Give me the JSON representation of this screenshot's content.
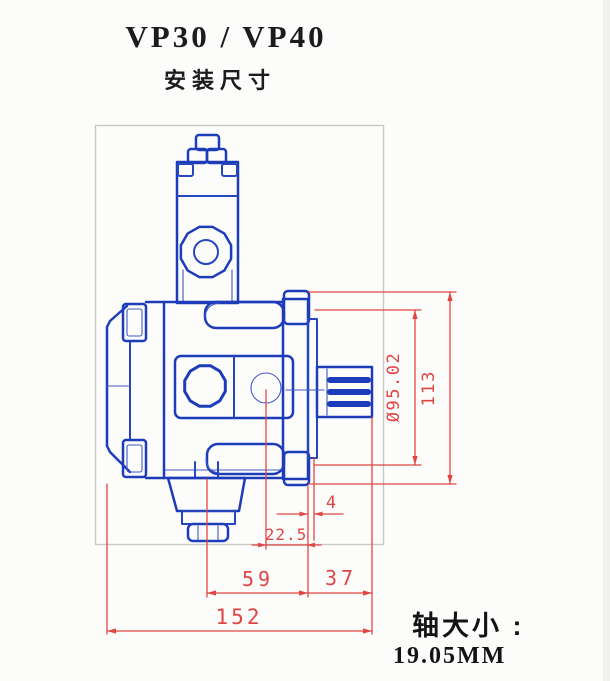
{
  "page": {
    "title": "VP30 / VP40",
    "subtitle": "安装尺寸"
  },
  "colors": {
    "part_line": "#1d3cba",
    "dimension_line": "#e04545",
    "frame_line": "#c9c9c4",
    "text": "#1c1c1e"
  },
  "dimensions": {
    "pilot_diameter": "Ø95.02",
    "flange_height": "113",
    "hub_offset": "4",
    "port_to_flange": "22.5",
    "port_to_flange_face": "59",
    "flange_to_shaft_end": "37",
    "overall_length": "152"
  },
  "footer": {
    "shaft_size_label": "轴大小 :",
    "shaft_size_value": "19.05MM"
  }
}
